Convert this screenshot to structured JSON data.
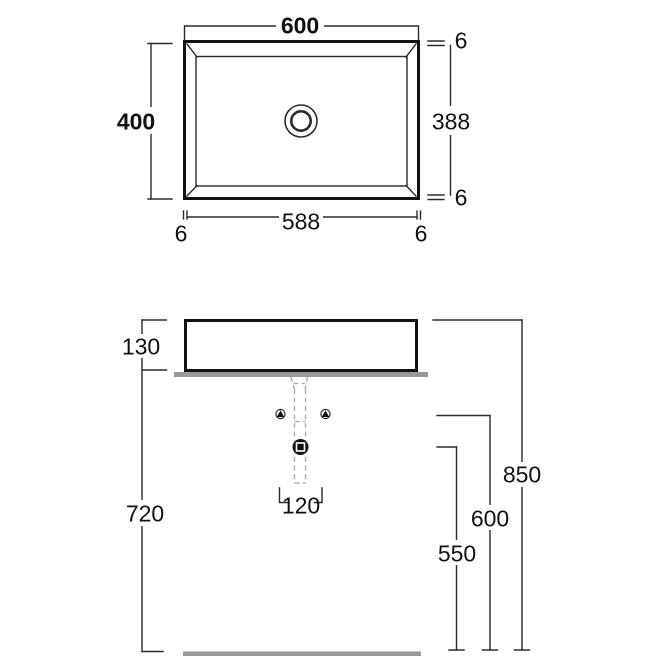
{
  "colors": {
    "line": "#2b2b2b",
    "heavy": "#111111",
    "gray": "#999999",
    "dash": "#a8a8a8",
    "text": "#111111"
  },
  "top_view": {
    "outer_width": "600",
    "outer_depth": "400",
    "bowl_width": "588",
    "bowl_depth": "388",
    "rim_right_top": "6",
    "rim_right_bottom": "6",
    "rim_bottom_left": "6",
    "rim_bottom_right": "6"
  },
  "front_view": {
    "basin_height": "130",
    "counter_height": "720",
    "total_height": "850",
    "supply_height": "600",
    "drain_height": "550",
    "hole_spacing": "120"
  }
}
